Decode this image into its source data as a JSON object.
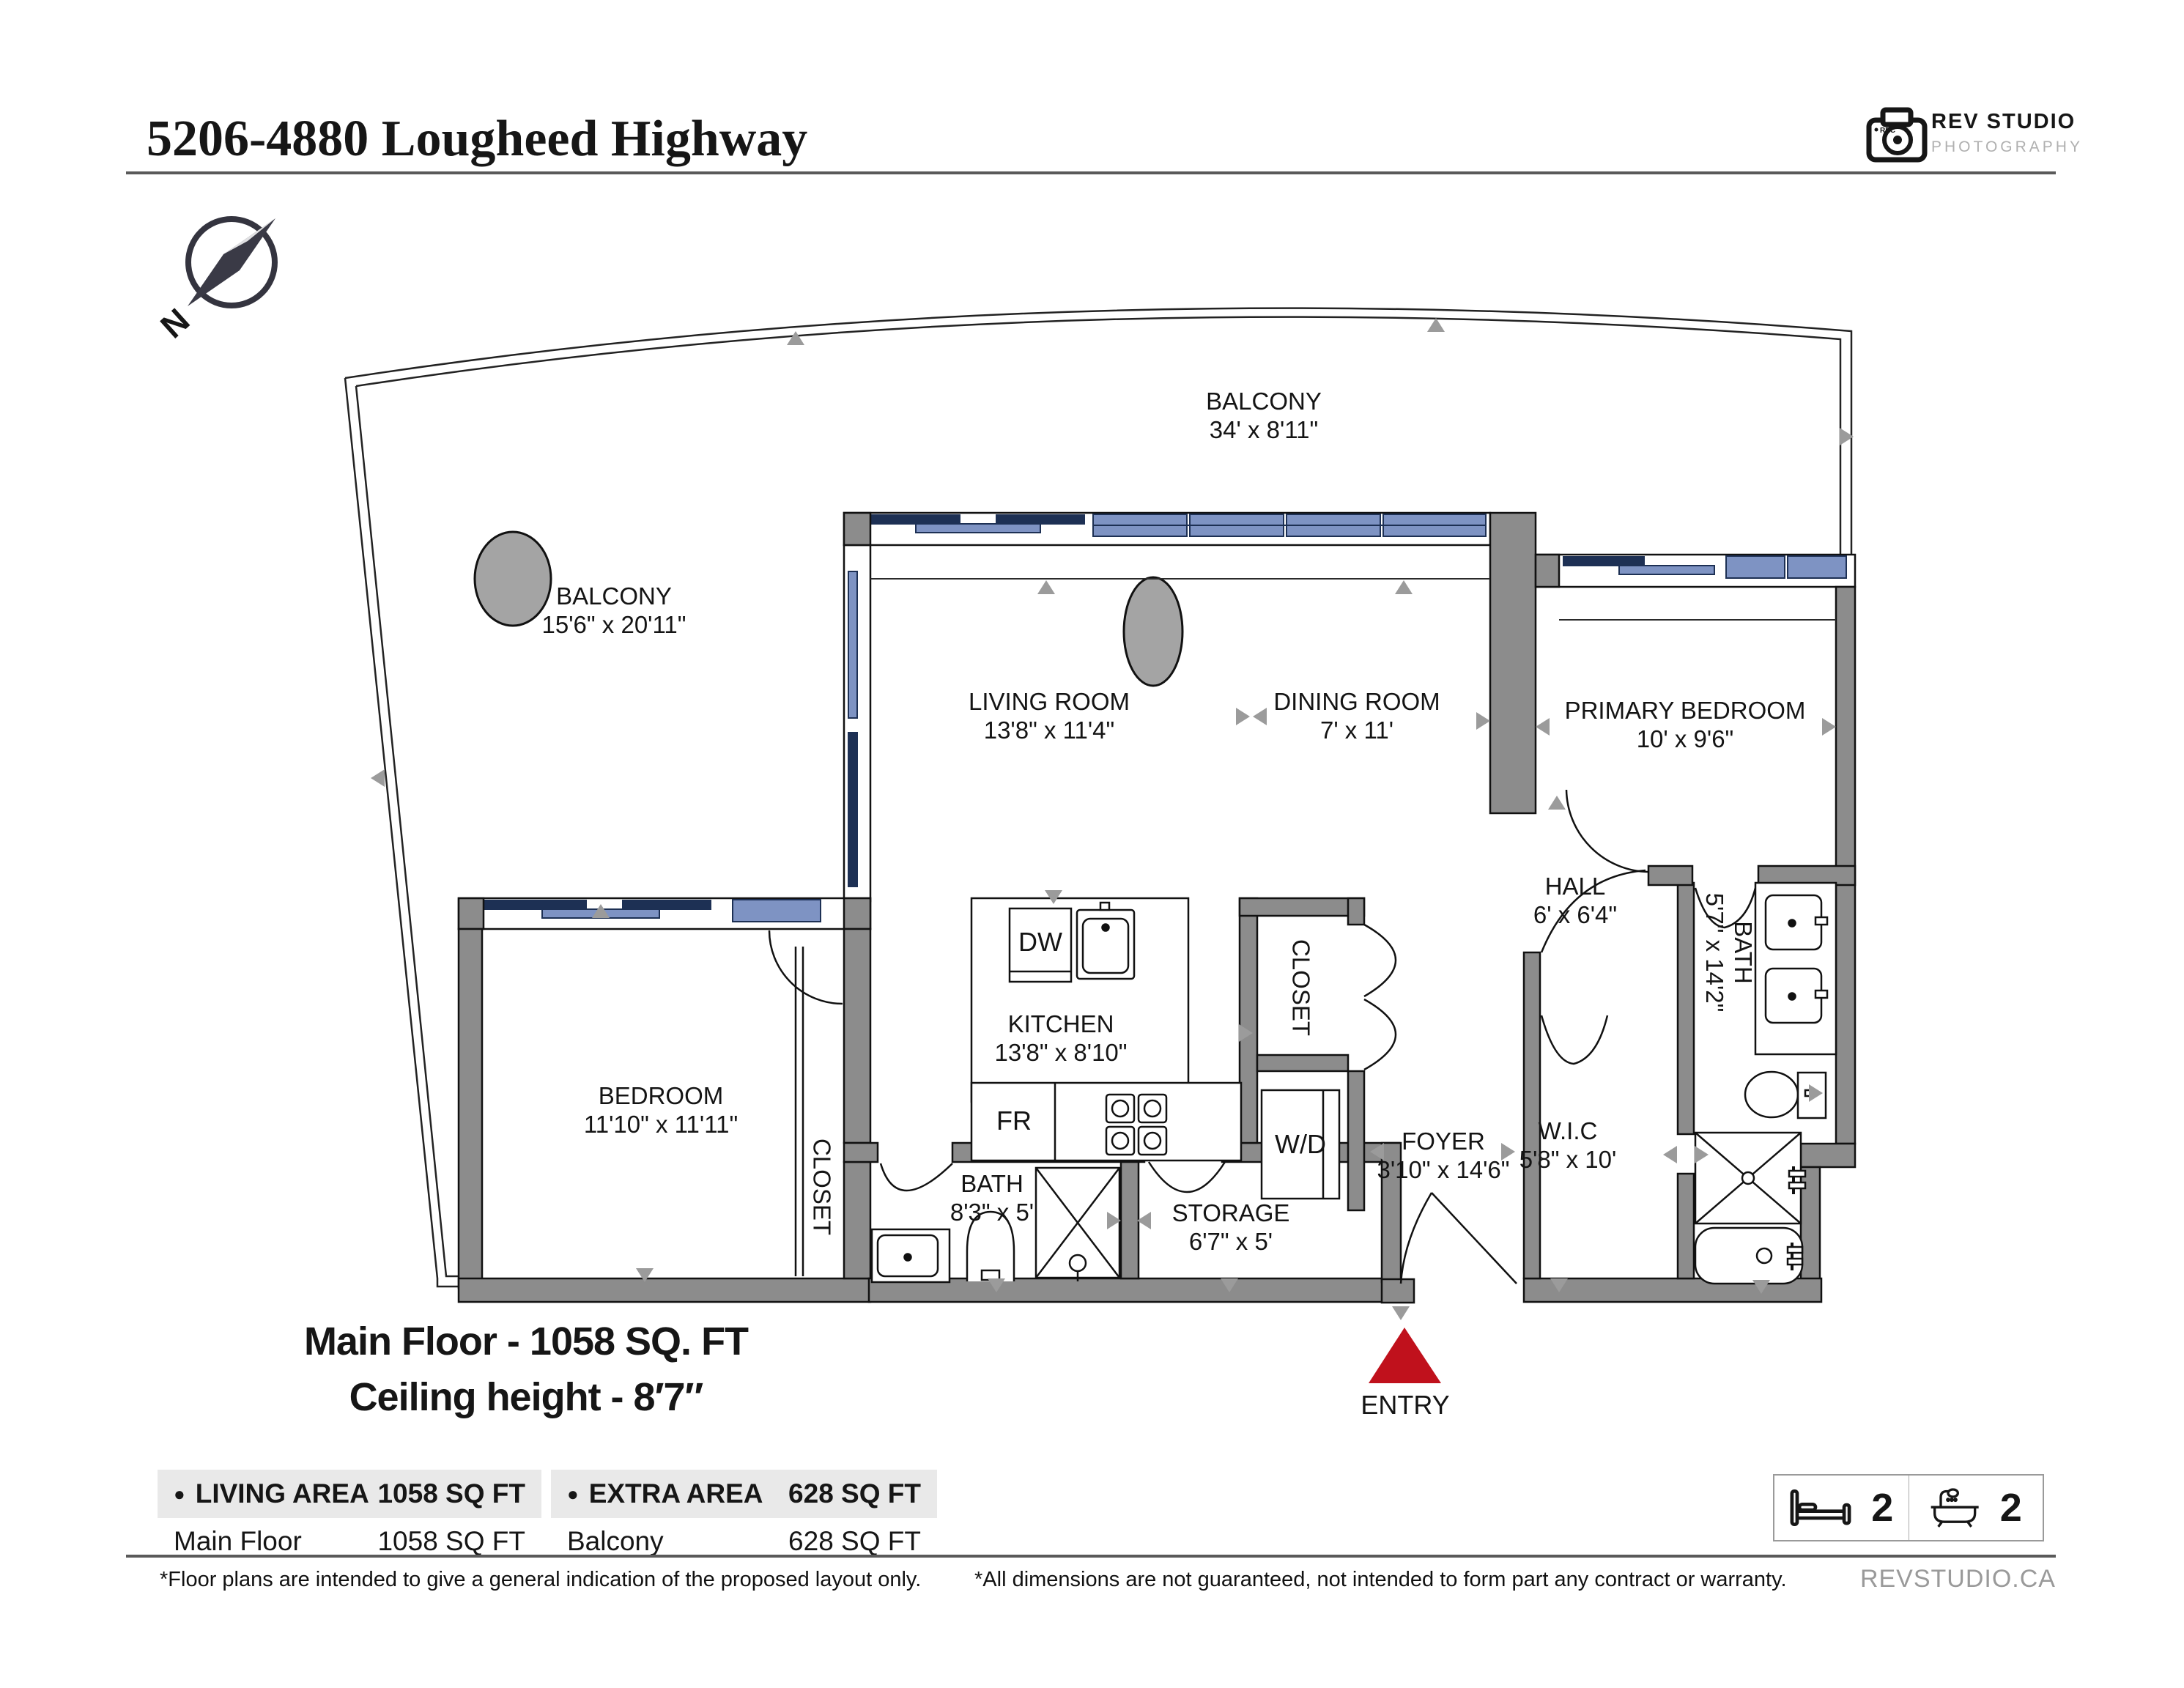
{
  "header": {
    "title": "5206-4880 Lougheed Highway"
  },
  "logo": {
    "brand_line1": "REV STUDIO",
    "brand_line2": "PHOTOGRAPHY",
    "rec_label": "REC",
    "website": "REVSTUDIO.CA"
  },
  "compass": {
    "north_label": "N"
  },
  "plan": {
    "rooms": [
      {
        "name": "BALCONY",
        "dims": "34' x 8'11\""
      },
      {
        "name": "BALCONY",
        "dims": "15'6\" x 20'11\""
      },
      {
        "name": "LIVING ROOM",
        "dims": "13'8\" x 11'4\""
      },
      {
        "name": "DINING ROOM",
        "dims": "7' x 11'"
      },
      {
        "name": "PRIMARY BEDROOM",
        "dims": "10' x 9'6\""
      },
      {
        "name": "HALL",
        "dims": "6' x 6'4\""
      },
      {
        "name": "KITCHEN",
        "dims": "13'8\" x 8'10\""
      },
      {
        "name": "BEDROOM",
        "dims": "11'10\" x 11'11\""
      },
      {
        "name": "CLOSET"
      },
      {
        "name": "CLOSET"
      },
      {
        "name": "W/D"
      },
      {
        "name": "FOYER",
        "dims": "3'10\" x 14'6\""
      },
      {
        "name": "BATH",
        "dims": "8'3\" x 5'"
      },
      {
        "name": "STORAGE",
        "dims": "6'7\" x 5'"
      },
      {
        "name": "W.I.C",
        "dims": "5'8\" x 10'"
      },
      {
        "name": "BATH",
        "dims": "5'7\" x 14'2\""
      },
      {
        "name": "DW"
      },
      {
        "name": "FR"
      }
    ],
    "entry_label": "ENTRY"
  },
  "summary": {
    "line1": "Main Floor - 1058 SQ. FT",
    "line2": "Ceiling height - 8′7″"
  },
  "area_table": {
    "bullet": "●",
    "living": {
      "header": "LIVING AREA",
      "header_value": "1058 SQ FT",
      "row_label": "Main Floor",
      "row_value": "1058 SQ FT"
    },
    "extra": {
      "header": "EXTRA AREA",
      "header_value": "628 SQ FT",
      "row_label": "Balcony",
      "row_value": "628 SQ FT"
    }
  },
  "stats": {
    "beds": "2",
    "baths": "2"
  },
  "footnotes": {
    "left": "*Floor plans are intended to give a general indication of the proposed layout only.",
    "right": "*All dimensions are not guaranteed, not intended to form part any contract or warranty."
  },
  "colors": {
    "wall_gray": "#8c8c8c",
    "window_light": "#7e93c3",
    "window_dark": "#1d3054",
    "entry_red": "#c0111c",
    "marker_gray": "#9b9b9b",
    "table_header_bg": "#e9e9e9"
  }
}
